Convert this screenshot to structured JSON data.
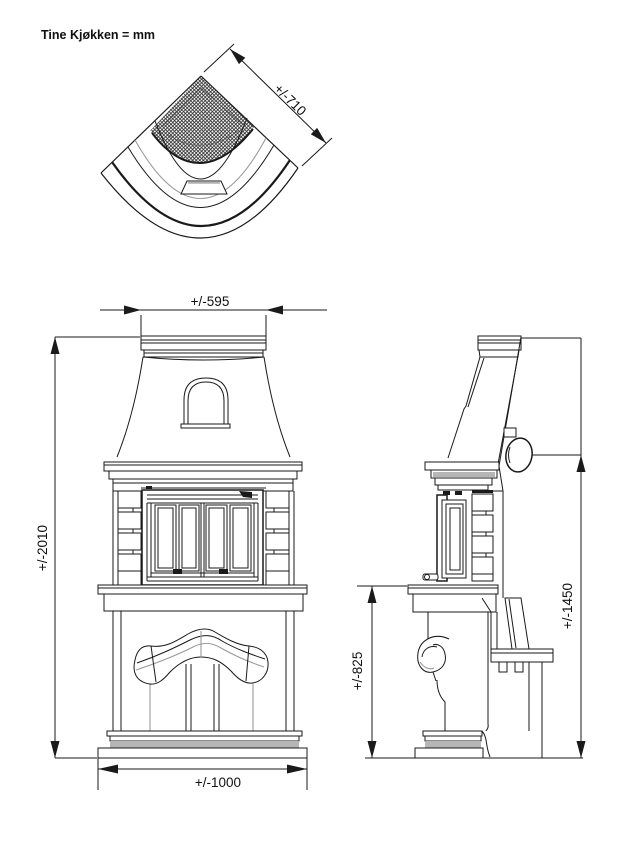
{
  "title": "Tine Kjøkken = mm",
  "dimensions": {
    "plan_depth": "+/-710",
    "front_top_width": "+/-595",
    "front_height": "+/-2010",
    "front_base_width": "+/-1000",
    "side_hearth_height": "+/-825",
    "side_flue_height": "+/-1450"
  },
  "colors": {
    "line": "#1a1a1a",
    "gray_line": "#9a9a9a",
    "gray_fill": "#b6b6b6",
    "background": "#ffffff"
  }
}
